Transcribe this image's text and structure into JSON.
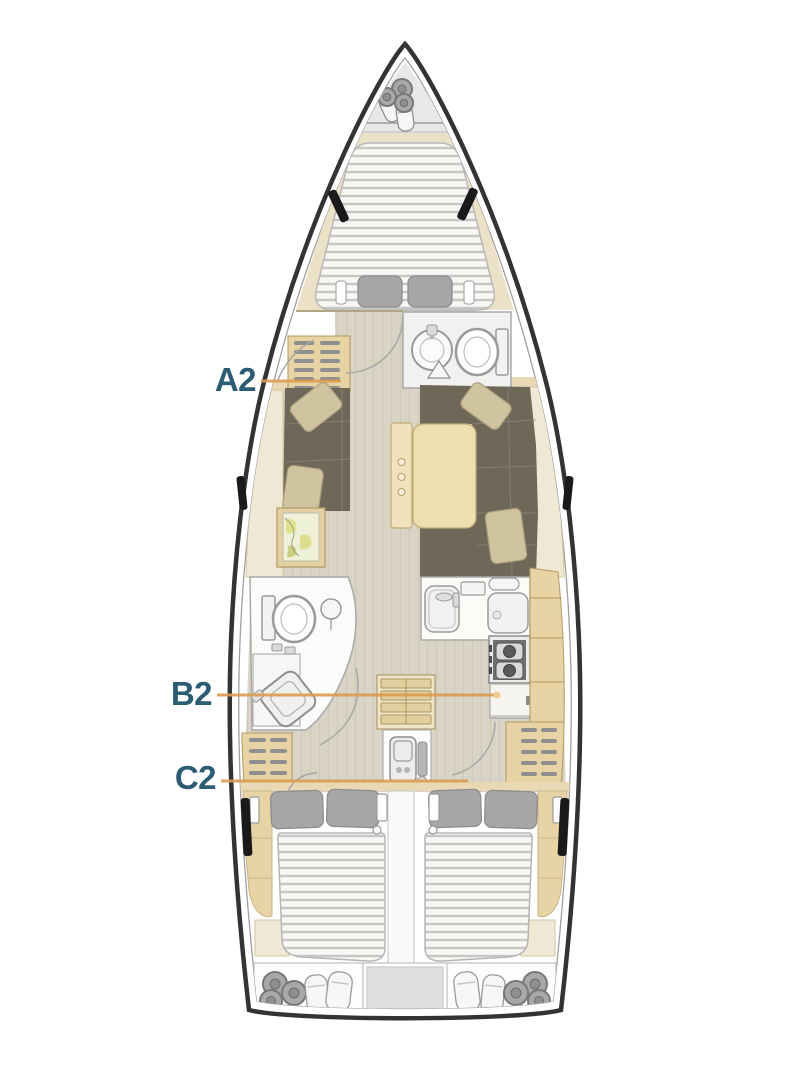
{
  "diagram": {
    "type": "sailing-yacht-interior-floorplan",
    "background": "#ffffff",
    "cabin_labels": [
      {
        "id": "A2",
        "text": "A2"
      },
      {
        "id": "B2",
        "text": "B2"
      },
      {
        "id": "C2",
        "text": "C2"
      }
    ],
    "colors": {
      "label_text": "#2a5d74",
      "leader_line": "#dc9c4f",
      "leader_dot": "#f0c993",
      "hull_line": "#333333",
      "hull_inner_line": "#a0a0a0",
      "wood": "#e7d3a4",
      "wood_dark": "#b49a62",
      "cream": "#ece2c8",
      "floor": "#d9d4c6",
      "sofa": "#6f6859",
      "sofa_seam": "#8d8575",
      "saloon_pillow": "#cfc3a0",
      "cabin_pillow": "#a6a6a6",
      "mattress": "#f8f7f3",
      "mattress_stripe": "#c6c6c6",
      "fixture_white": "#fbfbfa",
      "fixture_line": "#9a9a9a",
      "map_base": "#eef0d8",
      "map_yellow": "#e0e08a",
      "stove_dark": "#6f6f6f",
      "window_black": "#1a1a1a",
      "rope_gray": "#a8a8a8"
    },
    "areas": [
      "anchor-locker",
      "v-berth-forward-cabin",
      "forward-head",
      "saloon",
      "chart-table",
      "wet-head",
      "nav-station",
      "companionway-stairs",
      "galley",
      "engine-compartment",
      "aft-cabin-port",
      "aft-cabin-starboard",
      "stern-lockers"
    ]
  }
}
